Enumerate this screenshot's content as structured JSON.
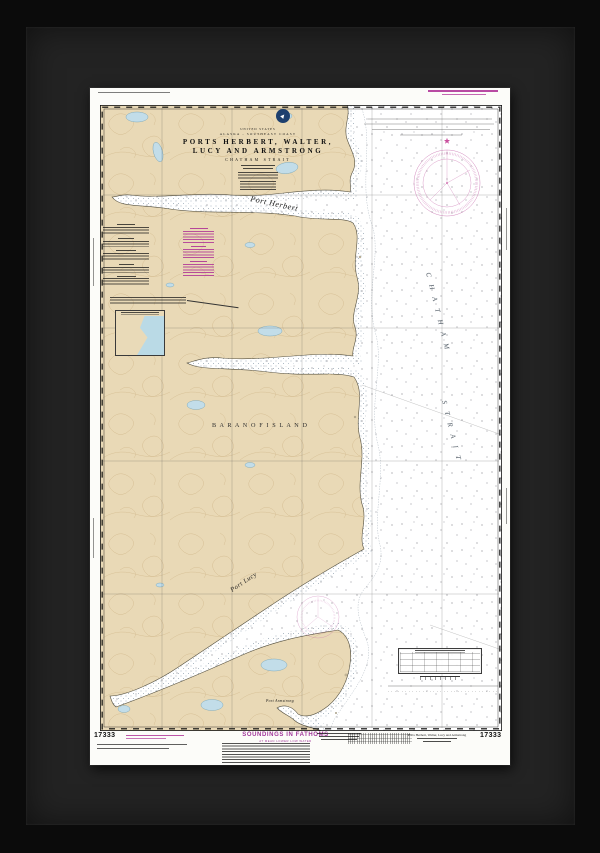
{
  "chart": {
    "title_block": {
      "country": "UNITED STATES",
      "region": "ALASKA - SOUTHEAST COAST",
      "title_line1": "PORTS  HERBERT,  WALTER,",
      "title_line2": "LUCY  AND  ARMSTRONG",
      "subtitle": "CHATHAM  STRAIT"
    },
    "number": "17333",
    "soundings": {
      "label": "SOUNDINGS IN FATHOMS",
      "sublabel": "AT MEAN LOWER LOW WATER"
    },
    "footer": {
      "title": "Ports Herbert, Walter, Lucy and Armstrong"
    },
    "place_labels": {
      "port_herbert": "Port Herbert",
      "baranof_island": "B A R A N O F    I S L A N D",
      "chatham_word1": "C H A T H A M",
      "chatham_word2": "S T R A I T",
      "port_lucy": "Port  Lucy",
      "port_armstrong": "Port  Armstrong"
    },
    "colors": {
      "land": "#e9d9b6",
      "contour": "#d5bd92",
      "lake": "#c2dde9",
      "magenta": "#c0318c",
      "paper": "#fcfcf9",
      "frame": "#0b0b0b",
      "mat": "#232323"
    }
  }
}
